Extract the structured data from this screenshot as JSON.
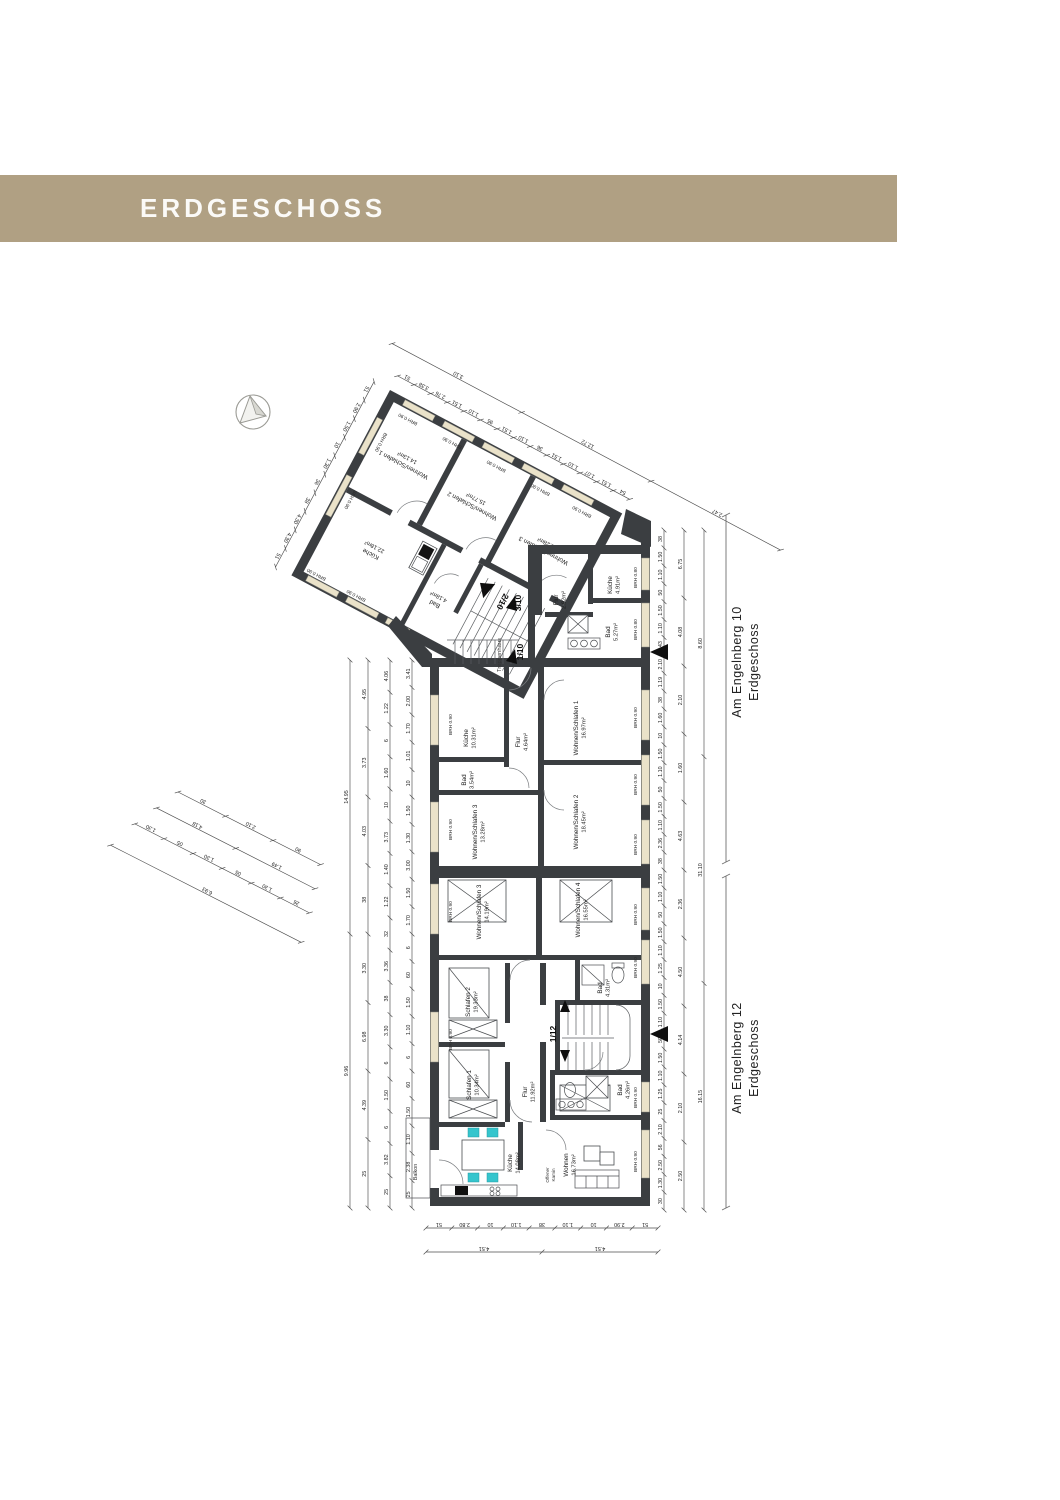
{
  "page": {
    "title": "ERDGESCHOSS"
  },
  "colors": {
    "header_bg": "#b0a083",
    "wall": "#3b3e41",
    "window_sill": "#eae2c9",
    "chair_accent": "#35c5cd"
  },
  "labels": {
    "brh90": "BRH 0.90",
    "brh80": "BRH 0.80",
    "treppenhaus": "Treppenhaus",
    "balkon": "Balkon",
    "kamin1": "Offener",
    "kamin2": "Kamin"
  },
  "markers": {
    "m210": "2/10",
    "m310": "3/10",
    "m110": "1/10",
    "m112": "1/12"
  },
  "rooms": {
    "w210_ws1": {
      "name": "Wohnen/Schlafen 1",
      "area": "14.13m²"
    },
    "w210_ws2": {
      "name": "Wohnen/Schlafen 2",
      "area": "15.77m²"
    },
    "w210_ws3": {
      "name": "Wohnen/Schlafen 3",
      "area": "15.28m²"
    },
    "w210_kueche": {
      "name": "Küche",
      "area": "22.18m²"
    },
    "w210_bad": {
      "name": "Bad",
      "area": "4.18m²"
    },
    "w310_kueche": {
      "name": "Küche",
      "area": "4.91m²"
    },
    "w310_flur": {
      "name": "Flur",
      "area": "2.92m²"
    },
    "w310_bad": {
      "name": "Bad",
      "area": "5.27m²"
    },
    "w110_kueche": {
      "name": "Küche",
      "area": "10.31m²"
    },
    "w110_flur": {
      "name": "Flur",
      "area": "4.64m²"
    },
    "w110_bad": {
      "name": "Bad",
      "area": "3.54m²"
    },
    "w110_ws1": {
      "name": "Wohnen/Schlafen 1",
      "area": "16.97m²"
    },
    "w110_ws2": {
      "name": "Wohnen/Schlafen 2",
      "area": "18.45m²"
    },
    "w110_ws3": {
      "name": "Wohnen/Schlafen 3",
      "area": "13.28m²"
    },
    "w112_ws3": {
      "name": "Wohnen/Schlafen 3",
      "area": "14.19m²"
    },
    "w112_ws4": {
      "name": "Wohnen/Schlafen 4",
      "area": "16.55m²"
    },
    "w112_schlafen2": {
      "name": "Schlafen 2",
      "area": "19.33m²"
    },
    "w112_schlafen1": {
      "name": "Schlafen 1",
      "area": "10.34m²"
    },
    "w112_flur": {
      "name": "Flur",
      "area": "11.92m²"
    },
    "w112_bad_o": {
      "name": "Bad",
      "area": "4.31m²"
    },
    "w112_bad_u": {
      "name": "Bad",
      "area": "4.26m²"
    },
    "w112_kueche": {
      "name": "Küche",
      "area": "14.08m²"
    },
    "w112_wohnen": {
      "name": "Wohnen",
      "area": "16.73m²"
    }
  },
  "annotations": {
    "building10": {
      "line1": "Am Engelnberg 10",
      "line2": "Erdgeschoss"
    },
    "building12": {
      "line1": "Am Engelnberg 12",
      "line2": "Erdgeschoss"
    }
  },
  "dims": {
    "left1": [
      "25",
      "2.38",
      "1.10",
      "1.50",
      "60",
      "6",
      "1.10",
      "1.50",
      "60",
      "6",
      "1.70",
      "1.50",
      "3.00",
      "1.30",
      "1.50",
      "10",
      "1.01",
      "1.70",
      "2.00",
      "3.41"
    ],
    "left2": [
      "25",
      "3.82",
      "6",
      "1.50",
      "6",
      "3.30",
      "38",
      "3.36",
      "32",
      "1.22",
      "1.40",
      "3.73",
      "10",
      "1.60",
      "6",
      "1.22",
      "4.06"
    ],
    "left3": [
      "25",
      "4.39",
      "6.98",
      "3.30",
      "38",
      "4.03",
      "3.73",
      "4.95"
    ],
    "left4": [
      "9.96",
      "14.95"
    ],
    "right1": [
      "30",
      "1.30",
      "2.50",
      "56",
      "2.10",
      "25",
      "1.25",
      "1.10",
      "1.50",
      "50",
      "1.10",
      "1.50",
      "10",
      "1.25",
      "1.10",
      "1.50",
      "50",
      "1.10",
      "1.50",
      "38",
      "2.36",
      "1.10",
      "1.50",
      "50",
      "1.10",
      "1.50",
      "10",
      "1.60",
      "38",
      "1.19",
      "2.10",
      "1.43",
      "1.10",
      "1.50",
      "50",
      "1.10",
      "1.50",
      "38"
    ],
    "right2": [
      "2.50",
      "2.10",
      "4.14",
      "4.50",
      "2.36",
      "4.63",
      "1.60",
      "2.10",
      "4.08",
      "6.75"
    ],
    "right3": [
      "16.15",
      "31.10",
      "8.60"
    ],
    "bottom1": [
      "51",
      "2.80",
      "10",
      "1.10",
      "38",
      "1.10",
      "10",
      "2.90",
      "51"
    ],
    "bottom2": [
      "4.51",
      "4.51"
    ],
    "wing_top1": [
      "51",
      "3.38",
      "2.76",
      "1.51",
      "1.10",
      "95",
      "1.51",
      "1.10",
      "36",
      "1.51",
      "1.10",
      "1.07",
      "1.51",
      "54"
    ],
    "wing_top2": [
      "3.10",
      "12.72",
      "2.47"
    ],
    "wing_left": [
      "51",
      "4.30",
      "4.30",
      "38",
      "36",
      "1.30",
      "10",
      "1.50",
      "2.90",
      "51"
    ],
    "small1": [
      "30",
      "2.10",
      "90"
    ],
    "small2": [
      "4.18",
      "1.49"
    ],
    "small3": [
      "1.30",
      "05",
      "1.30",
      "05",
      "1.30",
      "26"
    ],
    "small4": [
      "6.93"
    ]
  }
}
